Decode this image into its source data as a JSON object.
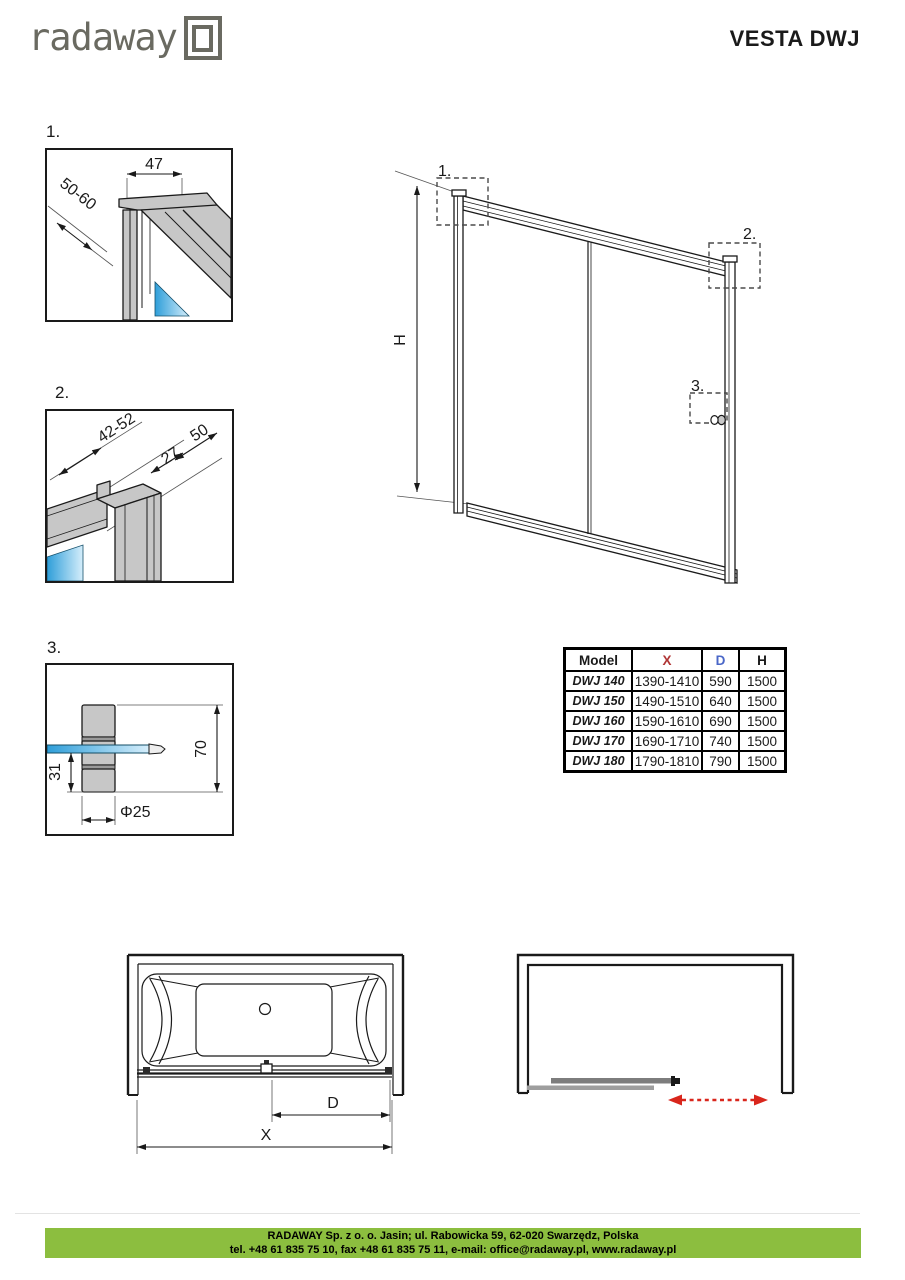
{
  "header": {
    "logo_text": "radaway",
    "title": "VESTA DWJ"
  },
  "details": {
    "d1": {
      "label": "1.",
      "dim_top": "47",
      "dim_diag": "50-60"
    },
    "d2": {
      "label": "2.",
      "dim_a": "42-52",
      "dim_b": "50",
      "dim_c": "27"
    },
    "d3": {
      "label": "3.",
      "dim_height": "70",
      "dim_offset": "31",
      "dim_dia": "Φ25"
    }
  },
  "main_drawing": {
    "dim_height": "H",
    "callout_1": "1.",
    "callout_2": "2.",
    "callout_3": "3."
  },
  "size_table": {
    "headers": [
      "Model",
      "X",
      "D",
      "H"
    ],
    "rows": [
      [
        "DWJ 140",
        "1390-1410",
        "590",
        "1500"
      ],
      [
        "DWJ 150",
        "1490-1510",
        "640",
        "1500"
      ],
      [
        "DWJ 160",
        "1590-1610",
        "690",
        "1500"
      ],
      [
        "DWJ 170",
        "1690-1710",
        "740",
        "1500"
      ],
      [
        "DWJ 180",
        "1790-1810",
        "790",
        "1500"
      ]
    ]
  },
  "plans": {
    "dim_d": "D",
    "dim_x": "X"
  },
  "footer": {
    "line1": "RADAWAY Sp. z o. o. Jasin; ul. Rabowicka 59, 62-020 Swarzędz, Polska",
    "line2": "tel. +48 61 835 75 10, fax +48 61 835 75 11, e-mail: office@radaway.pl, www.radaway.pl"
  },
  "colors": {
    "accent_green": "#8cbe3f",
    "dim_red": "#b03535",
    "arrow_red": "#d9261c",
    "dim_blue": "#4a67c8",
    "glass_blue": "#2e9ed9",
    "profile_gray": "#c7c7c7",
    "logo_gray": "#6a6a61"
  }
}
